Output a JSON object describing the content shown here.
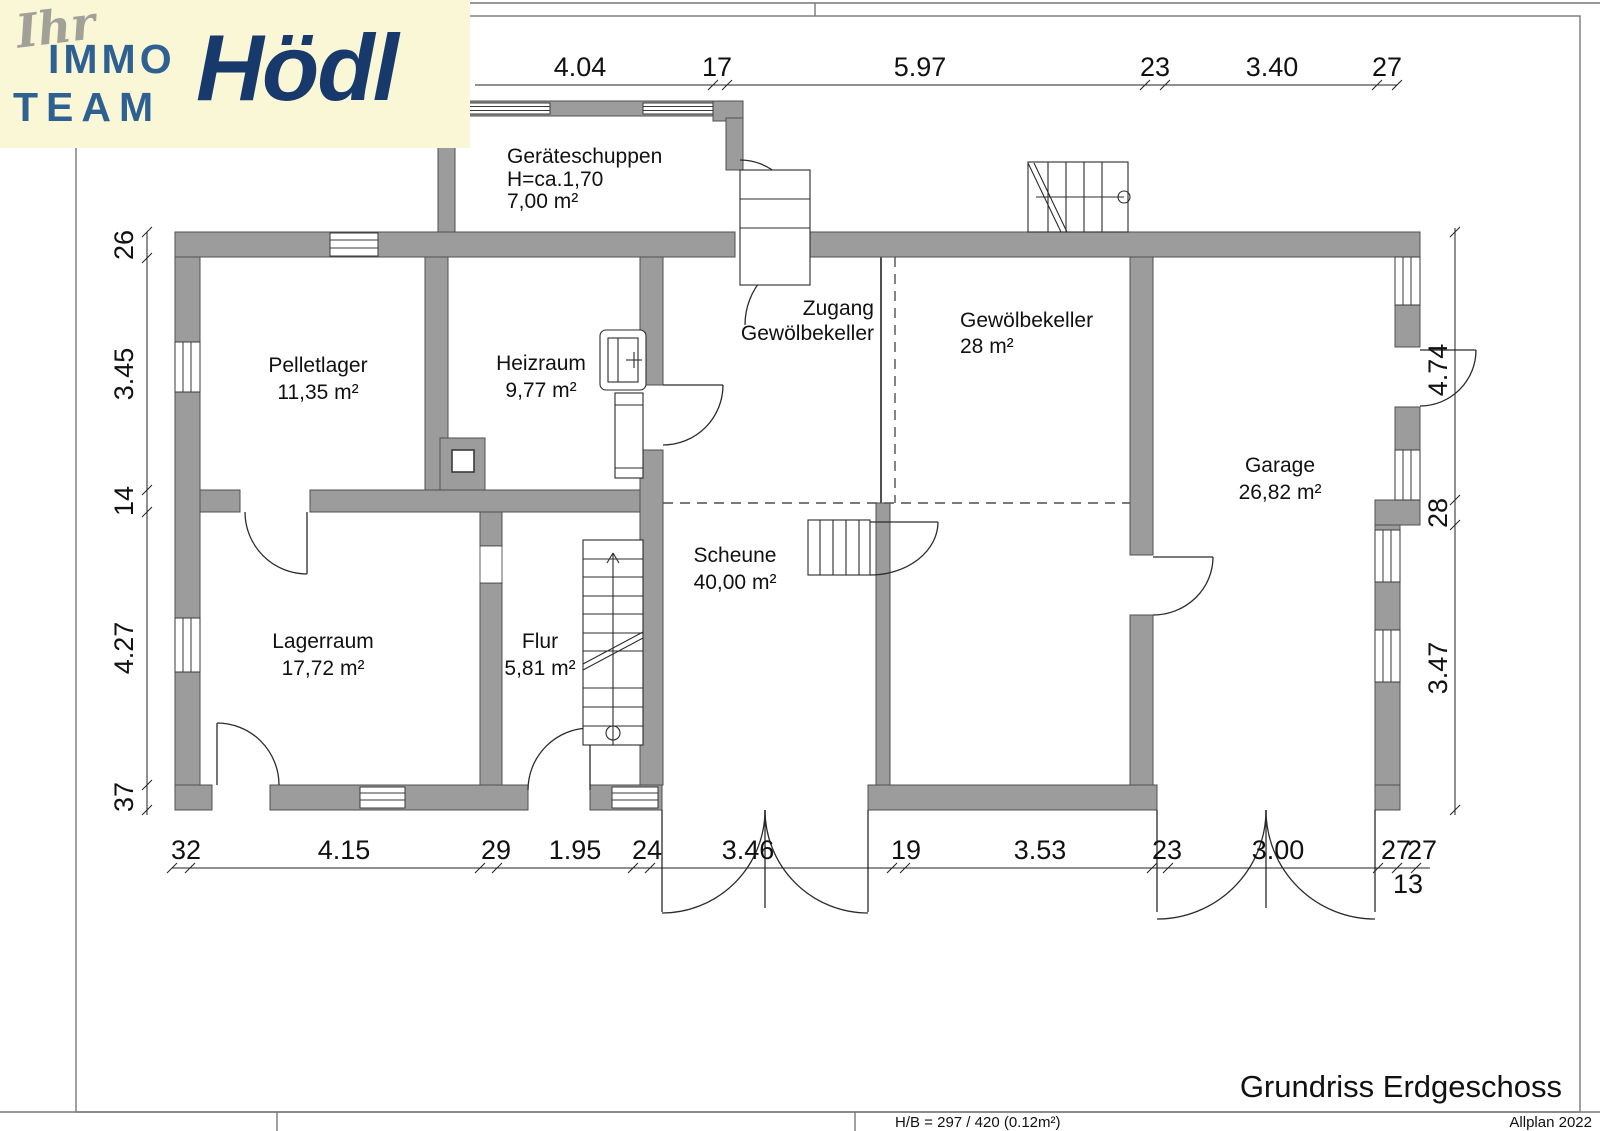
{
  "logo": {
    "script": "Ihr",
    "word1": "IMMO",
    "word2": "TEAM",
    "brand": "Hödl"
  },
  "sheet": {
    "title": "Grundriss Erdgeschoss",
    "footer_left": "H/B = 297 / 420 (0.12m²)",
    "footer_right": "Allplan 2022"
  },
  "rooms": {
    "geraeteschuppen": {
      "name": "Geräteschuppen",
      "height": "H=ca.1,70",
      "area": "7,00 m²"
    },
    "pelletlager": {
      "name": "Pelletlager",
      "area": "11,35 m²"
    },
    "heizraum": {
      "name": "Heizraum",
      "area": "9,77 m²"
    },
    "zugang": {
      "line1": "Zugang",
      "line2": "Gewölbekeller"
    },
    "gewoelbekeller": {
      "name": "Gewölbekeller",
      "area": "28 m²"
    },
    "garage": {
      "name": "Garage",
      "area": "26,82 m²"
    },
    "scheune": {
      "name": "Scheune",
      "area": "40,00 m²"
    },
    "lagerraum": {
      "name": "Lagerraum",
      "area": "17,72 m²"
    },
    "flur": {
      "name": "Flur",
      "area": "5,81 m²"
    }
  },
  "dimensions": {
    "top": [
      "4.04",
      "17",
      "5.97",
      "23",
      "3.40",
      "27"
    ],
    "left": [
      "26",
      "3.45",
      "14",
      "4.27",
      "37"
    ],
    "right": [
      "4.74",
      "28",
      "3.47"
    ],
    "bottom": [
      "32",
      "4.15",
      "29",
      "1.95",
      "24",
      "3.46",
      "19",
      "3.53",
      "23",
      "3.00",
      "27",
      "27"
    ],
    "bottom_sub": "13"
  },
  "colors": {
    "wall_fill": "#9c9c9c",
    "wall_stroke": "#4f4f4f",
    "logo_background": "#faf7d6",
    "logo_blue": "#2e6191",
    "logo_navy": "#17396b",
    "line_color": "#222222"
  }
}
